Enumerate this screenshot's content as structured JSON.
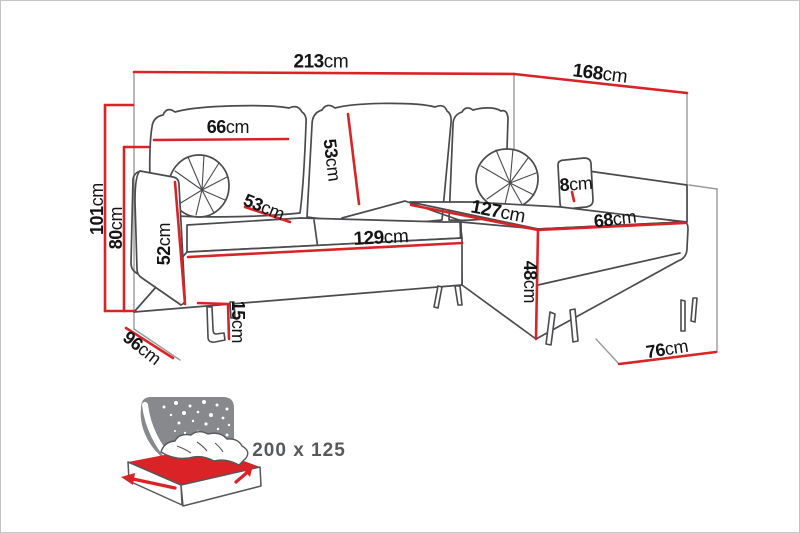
{
  "diagram_title": "corner-sofa-dimensions",
  "unit": "cm",
  "colors": {
    "dimension_red": "#d92327",
    "sofa_outline_gray": "#4a4b4e",
    "box_line_gray": "#9a9a9a",
    "label_black": "#141414",
    "icon_gray": "#87898c",
    "icon_text_gray": "#58595b"
  },
  "dimensions": [
    {
      "id": "back-width",
      "num": "213",
      "unit": "cm"
    },
    {
      "id": "side-length",
      "num": "168",
      "unit": "cm"
    },
    {
      "id": "total-height",
      "num": "101",
      "unit": "cm"
    },
    {
      "id": "backrest-height",
      "num": "80",
      "unit": "cm"
    },
    {
      "id": "back-cushion-width",
      "num": "66",
      "unit": "cm"
    },
    {
      "id": "back-cushion-height",
      "num": "53",
      "unit": "cm"
    },
    {
      "id": "seat-depth",
      "num": "53",
      "unit": "cm"
    },
    {
      "id": "armrest-height",
      "num": "52",
      "unit": "cm"
    },
    {
      "id": "seat-width",
      "num": "129",
      "unit": "cm"
    },
    {
      "id": "chaise-length",
      "num": "127",
      "unit": "cm"
    },
    {
      "id": "chaise-width",
      "num": "68",
      "unit": "cm"
    },
    {
      "id": "arm-cushion-thickness",
      "num": "8",
      "unit": "cm"
    },
    {
      "id": "chaise-seat-height",
      "num": "48",
      "unit": "cm"
    },
    {
      "id": "leg-height",
      "num": "15",
      "unit": "cm"
    },
    {
      "id": "depth-left",
      "num": "96",
      "unit": "cm"
    },
    {
      "id": "depth-right",
      "num": "76",
      "unit": "cm"
    }
  ],
  "bed_function": {
    "icon": "sofa-bed-fold-out",
    "size_label": "200 x 125"
  }
}
